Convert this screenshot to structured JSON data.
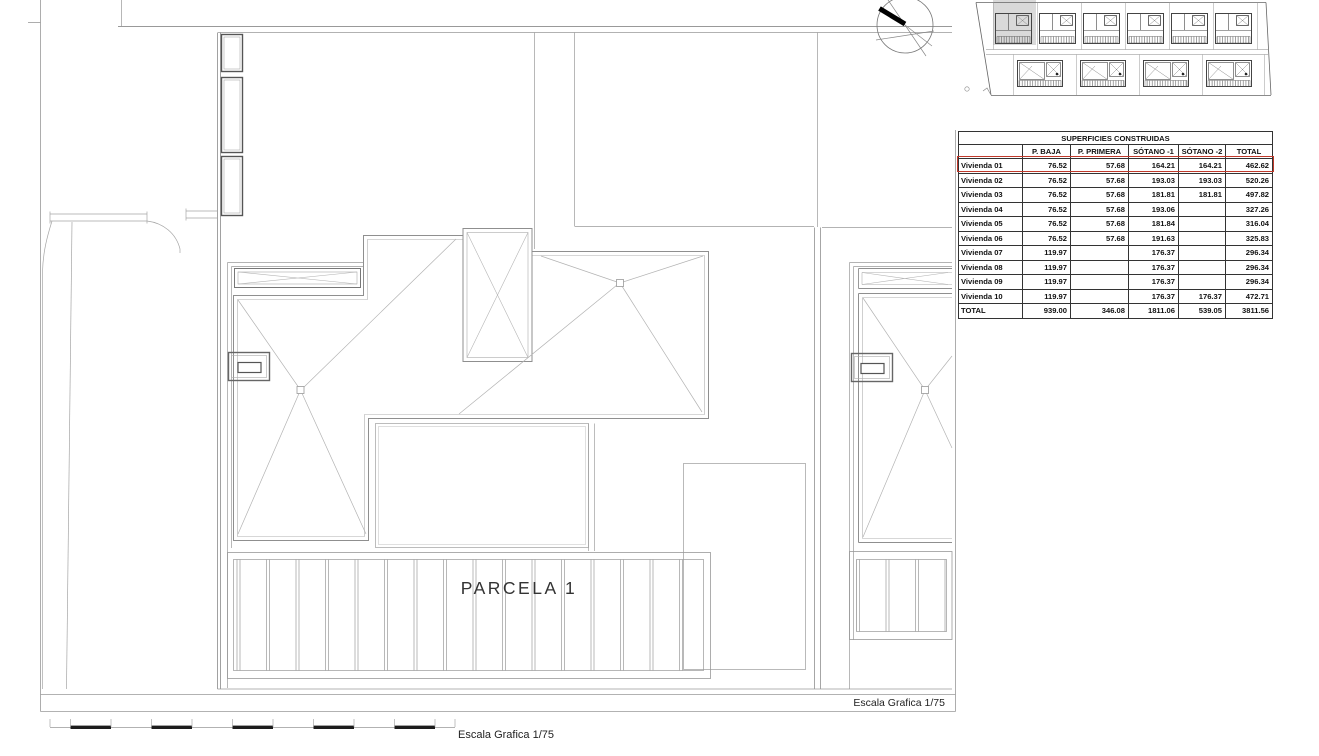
{
  "page": {
    "background": "#ffffff"
  },
  "drawing": {
    "parcela_label": "PARCELA 1",
    "frame_scale_caption": "Escala Grafica 1/75",
    "bottom_scale_caption": "Escala Grafica 1/75"
  },
  "key_plan": {
    "highlighted_plot": "top-left plot shaded gray",
    "top_row_house_count": 6,
    "bottom_row_house_count": 4,
    "highlight_fill": "#d9d9d9"
  },
  "table": {
    "title": "SUPERFICIES CONSTRUIDAS",
    "columns": [
      "",
      "P. BAJA",
      "P. PRIMERA",
      "SÓTANO -1",
      "SÓTANO -2",
      "TOTAL"
    ],
    "rows": [
      {
        "label": "Vivienda 01",
        "values": [
          "76.52",
          "57.68",
          "164.21",
          "164.21",
          "462.62"
        ],
        "highlight": true
      },
      {
        "label": "Vivienda 02",
        "values": [
          "76.52",
          "57.68",
          "193.03",
          "193.03",
          "520.26"
        ]
      },
      {
        "label": "Vivienda 03",
        "values": [
          "76.52",
          "57.68",
          "181.81",
          "181.81",
          "497.82"
        ]
      },
      {
        "label": "Vivienda 04",
        "values": [
          "76.52",
          "57.68",
          "193.06",
          "",
          "327.26"
        ]
      },
      {
        "label": "Vivienda 05",
        "values": [
          "76.52",
          "57.68",
          "181.84",
          "",
          "316.04"
        ]
      },
      {
        "label": "Vivienda 06",
        "values": [
          "76.52",
          "57.68",
          "191.63",
          "",
          "325.83"
        ]
      },
      {
        "label": "Vivienda 07",
        "values": [
          "119.97",
          "",
          "176.37",
          "",
          "296.34"
        ]
      },
      {
        "label": "Vivienda 08",
        "values": [
          "119.97",
          "",
          "176.37",
          "",
          "296.34"
        ]
      },
      {
        "label": "Vivienda 09",
        "values": [
          "119.97",
          "",
          "176.37",
          "",
          "296.34"
        ]
      },
      {
        "label": "Vivienda 10",
        "values": [
          "119.97",
          "",
          "176.37",
          "176.37",
          "472.71"
        ]
      },
      {
        "label": "TOTAL",
        "values": [
          "939.00",
          "346.08",
          "1811.06",
          "539.05",
          "3811.56"
        ]
      }
    ],
    "highlighted_row": "Vivienda 01",
    "highlight_color": "#c0392b"
  }
}
